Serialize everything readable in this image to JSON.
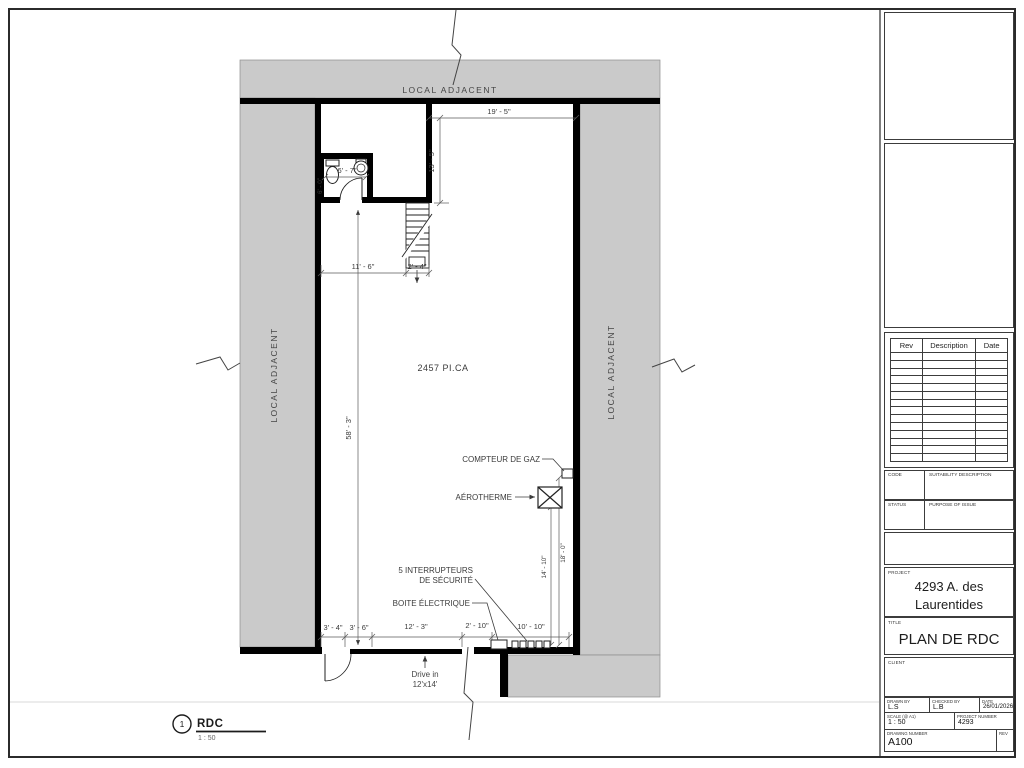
{
  "plan": {
    "adjacent_top": "LOCAL ADJACENT",
    "adjacent_left": "LOCAL ADJACENT",
    "adjacent_right": "LOCAL ADJACENT",
    "area": "2457 PI.CA",
    "dim_top_w": "19' - 5\"",
    "dim_top_h": "13' - 5\"",
    "dim_bath_w": "6' - 7\"",
    "dim_bath_h": "6' - 0\"",
    "dim_hall": "11' - 6\"",
    "dim_stair": "2' - 4\"",
    "dim_height": "58' - 3\"",
    "dim_right_a": "14' - 10\"",
    "dim_right_b": "18' - 0\"",
    "dim_b1": "3' - 4\"",
    "dim_b2": "3' - 6\"",
    "dim_b3": "12' - 3\"",
    "dim_b4": "2' - 10\"",
    "dim_b5": "10' - 10\"",
    "gas_label": "COMPTEUR DE GAZ",
    "aero_label": "AÉROTHERME",
    "switch_label_1": "5 INTERRUPTEURS",
    "switch_label_2": "DE SÉCURITÉ",
    "elec_label": "BOITE ÉLECTRIQUE",
    "drive_label_1": "Drive in",
    "drive_label_2": "12'x14'",
    "view_number": "1",
    "view_name": "RDC",
    "view_scale": "1 : 50"
  },
  "titleblock": {
    "rev_header_rev": "Rev",
    "rev_header_description": "Description",
    "rev_header_date": "Date",
    "rev_row_count": 14,
    "code_label": "CODE",
    "code_value": "SUITABILITY DESCRIPTION",
    "status_label": "STATUS",
    "status_value": "PURPOSE OF ISSUE",
    "project_label": "PROJECT",
    "project_value": "4293 A. des Laurentides",
    "title_label": "TITLE",
    "title_value": "PLAN DE RDC",
    "client_label": "CLIENT",
    "drawn_label": "DRAWN BY",
    "drawn_value": "L.S",
    "checked_label": "CHECKED BY",
    "checked_value": "L.B",
    "date_label": "DATE",
    "date_value": "26/01/2026",
    "scale_label": "SCALE (@ A1)",
    "scale_value": "1 : 50",
    "pnum_label": "PROJECT NUMBER",
    "pnum_value": "4293",
    "dnum_label": "DRAWING NUMBER",
    "dnum_value": "A100",
    "rev_label": "REV"
  }
}
